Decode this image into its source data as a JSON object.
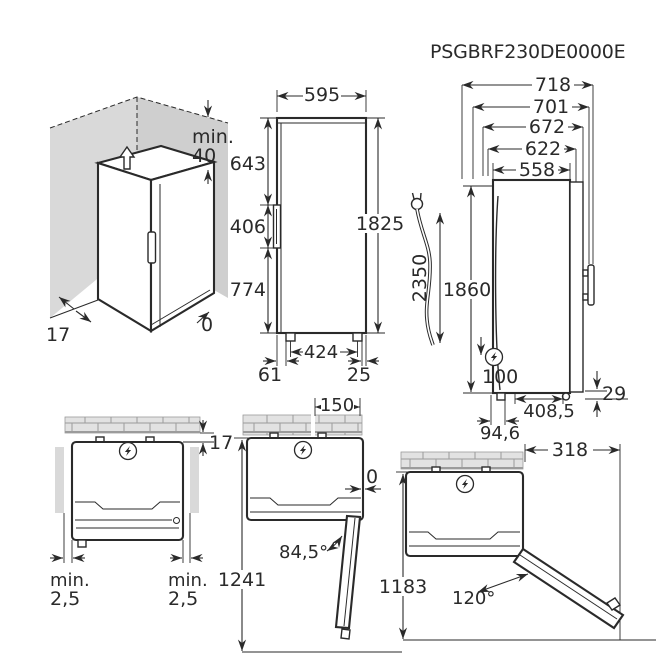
{
  "model_code": "PSGBRF230DE0000E",
  "colors": {
    "line": "#2a2a2a",
    "wall_gray": "#d9d9d9",
    "wall_gray_dark": "#cfcfcf",
    "brick_gray": "#e2e2e2"
  },
  "icons": {
    "power": "lightning-bolt-in-circle",
    "plug": "power-plug",
    "airflow": "up-arrow-outline"
  },
  "views": {
    "corner": {
      "min_label": "min.",
      "top_clearance": "40",
      "side_clearance": "17",
      "rear_clearance": "0"
    },
    "front": {
      "width": "595",
      "top_to_handle": "643",
      "handle_span": "406",
      "handle_to_floor": "774",
      "height": "1825",
      "feet_spacing": "424",
      "foot_offset_left": "61",
      "foot_offset_right": "25"
    },
    "cable": {
      "length": "2350"
    },
    "side": {
      "depth_1": "718",
      "depth_2": "701",
      "depth_3": "672",
      "depth_4": "622",
      "depth_5": "558",
      "height": "1860",
      "socket_offset": "100",
      "base_depth": "408,5",
      "rear_bottom_gap": "29",
      "front_bottom_offset": "94,6"
    },
    "plan_closed": {
      "wall_gap": "17",
      "min_label": "min.",
      "side_gap_left": "2,5",
      "side_gap_right": "2,5"
    },
    "plan_open_84": {
      "wall_side_clearance": "150",
      "flush_gap": "0",
      "door_angle": "84,5°",
      "depth_required": "1241"
    },
    "plan_open_120": {
      "side_clearance": "318",
      "door_angle": "120°",
      "depth_required": "1183"
    }
  }
}
